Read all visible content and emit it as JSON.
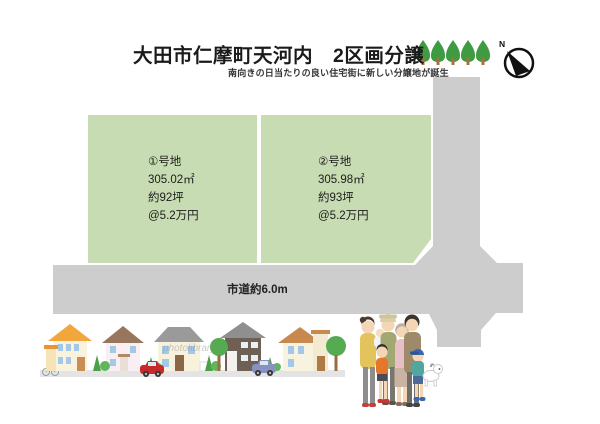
{
  "header": {
    "title": "大田市仁摩町天河内　2区画分譲",
    "subtitle": "南向きの日当たりの良い住宅街に新しい分譲地が誕生"
  },
  "lots": [
    {
      "label": "①号地",
      "area_m2": "305.02㎡",
      "area_tsubo": "約92坪",
      "unit_price": "@5.2万円"
    },
    {
      "label": "②号地",
      "area_m2": "305.98㎡",
      "area_tsubo": "約93坪",
      "unit_price": "@5.2万円"
    }
  ],
  "road": {
    "label": "市道約6.0m"
  },
  "compass": {
    "north_label": "N"
  },
  "watermark": "photolibrary",
  "colors": {
    "lot_green": "#c7dcb2",
    "road_gray": "#cdcdcd",
    "street_gray": "#e4e4e4",
    "tree_green": "#3f9b41",
    "trunk_brown": "#a5713c"
  }
}
